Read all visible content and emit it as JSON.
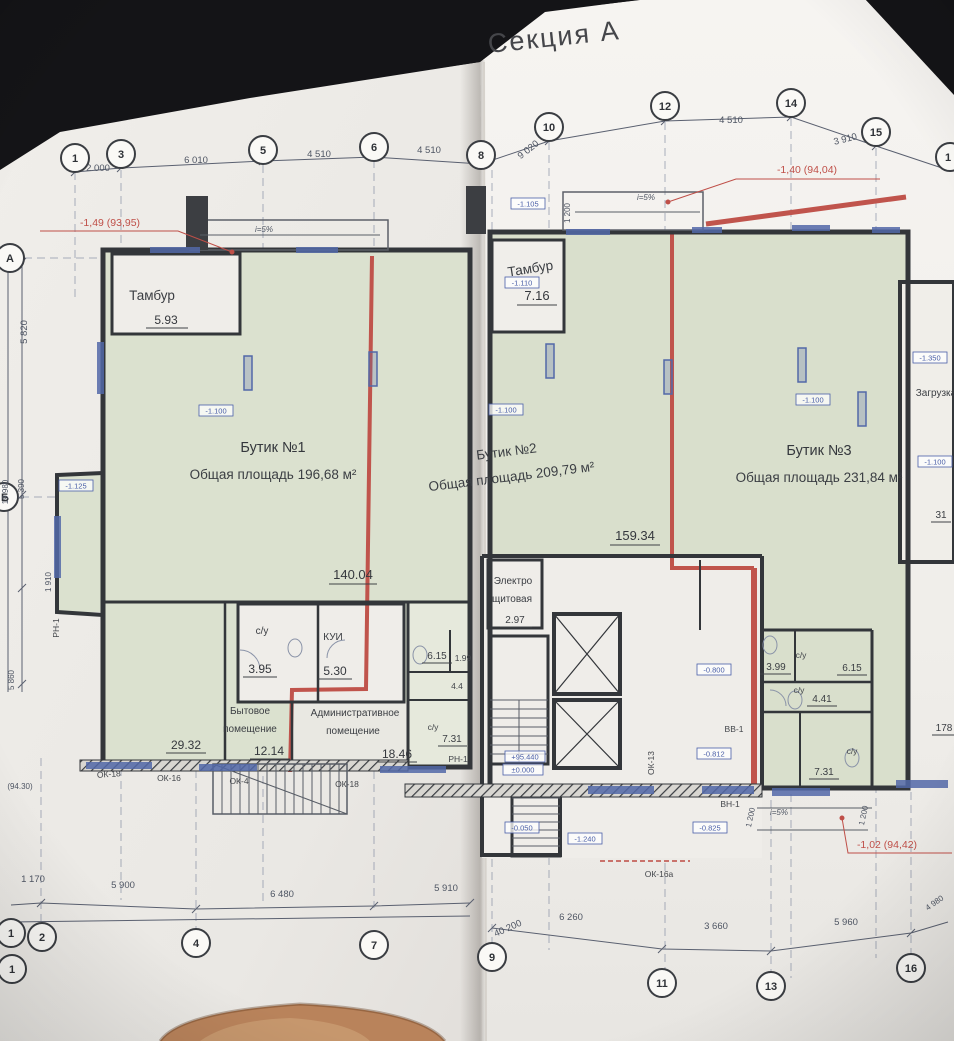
{
  "title": "Секция А",
  "axes": {
    "top": [
      "1",
      "3",
      "5",
      "6",
      "8",
      "10",
      "12",
      "14",
      "15",
      "1"
    ],
    "bottom": [
      "1",
      "2",
      "4",
      "7",
      "1",
      "9",
      "11",
      "13",
      "16"
    ],
    "left": [
      "А",
      "Б"
    ]
  },
  "dims": {
    "top": [
      "2 000",
      "6 010",
      "4 510",
      "4 510",
      "9 020",
      "4 510",
      "3 910"
    ],
    "bottom": [
      "1 170",
      "5 900",
      "6 480",
      "5 910",
      "40 200",
      "6 260",
      "3 660",
      "5 960",
      "4 980"
    ],
    "left": [
      "5 820",
      "19 980",
      "5 390",
      "1 910",
      "5 860",
      "(94.30)"
    ],
    "vert": [
      "1 200",
      "1 200",
      "1 200"
    ],
    "slope": "i=5%"
  },
  "elev": {
    "e1": "-1,49 (93,95)",
    "e2": "-1,40 (94,04)",
    "e3": "-1,02 (94,42)"
  },
  "rooms": {
    "tambur1": {
      "name": "Тамбур",
      "area": "5.93"
    },
    "tambur2": {
      "name": "Тамбур",
      "area": "7.16"
    },
    "butik1": {
      "name": "Бутик №1",
      "info": "Общая площадь 196,68 м²"
    },
    "butik2": {
      "name": "Бутик №2",
      "info": "Общая площадь 209,79 м²"
    },
    "butik3": {
      "name": "Бутик №3",
      "info": "Общая площадь 231,84 м²"
    },
    "electro": {
      "l1": "Электро",
      "l2": "щитовая",
      "area": "2.97"
    },
    "su": "с/у",
    "su1_area": "3.95",
    "kui": {
      "name": "КУИ",
      "area": "5.30"
    },
    "bytovoe": {
      "l1": "Бытовое",
      "l2": "помещение",
      "area": "12.14"
    },
    "admin": {
      "l1": "Административное",
      "l2": "помещение",
      "area": "18.46"
    },
    "zagruzka": "Загрузка",
    "areas": {
      "a2932": "29.32",
      "a14004": "140.04",
      "a15934": "159.34",
      "a615a": "6.15",
      "a199": "1.99",
      "a44": "4.4",
      "a731a": "7.31",
      "a399": "3.99",
      "a615b": "6.15",
      "a441": "4.41",
      "a731b": "7.31",
      "a178": "178",
      "a31": "31"
    }
  },
  "tags": {
    "t1100a": "-1.100",
    "t1125": "-1.125",
    "t1100b": "-1.100",
    "t1100c": "-1.100",
    "t1350": "-1.350",
    "t1100d": "-1.100",
    "t1105": "-1.105",
    "t1110": "-1.110",
    "t95440": "+95.440",
    "t0000": "±0.000",
    "t0050": "-0.050",
    "t1240": "-1.240",
    "t0800": "-0.800",
    "t0812": "-0.812",
    "t0825": "-0.825"
  },
  "openings": {
    "ok18a": "ОК-18",
    "ok16": "ОК-16",
    "ok4": "ОК-4",
    "ok18b": "ОК-18",
    "ok16a": "ОК-16а",
    "ok13": "ОК-13",
    "vv1": "ВВ-1",
    "vn1": "ВН-1",
    "rn1a": "РН-1",
    "rn1b": "РН-1"
  },
  "colors": {
    "paper": "#edebe7",
    "room_green": "#dbe1cf",
    "unit_line_red": "#c0544c",
    "window_blue": "#5268a8"
  }
}
